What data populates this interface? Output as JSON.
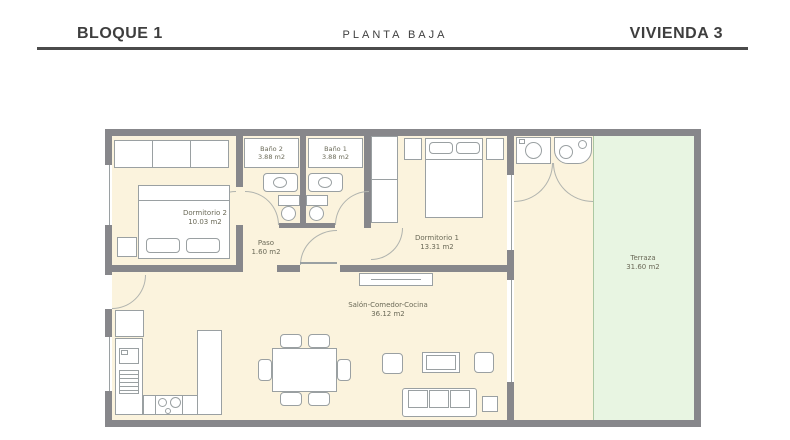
{
  "header": {
    "block_label": "BLOQUE 1",
    "plan_label": "PLANTA BAJA",
    "unit_label": "VIVIENDA 3"
  },
  "floorplan": {
    "rooms": {
      "dormitorio2": {
        "name": "Dormitorio 2",
        "area": "10.03 m2"
      },
      "bano2": {
        "name": "Baño 2",
        "area": "3.88 m2"
      },
      "bano1": {
        "name": "Baño 1",
        "area": "3.88 m2"
      },
      "paso": {
        "name": "Paso",
        "area": "1.60 m2"
      },
      "dormitorio1": {
        "name": "Dormitorio 1",
        "area": "13.31 m2"
      },
      "salon": {
        "name": "Salón-Comedor-Cocina",
        "area": "36.12 m2"
      },
      "terraza": {
        "name": "Terraza",
        "area": "31.60 m2"
      }
    },
    "colors": {
      "wall": "#87878b",
      "floor": "#fbf3dd",
      "terrace": "#e8f5e2",
      "furniture_line": "#9aa0a2",
      "label_text": "#6b6a58",
      "header_text": "#3e3e3e",
      "header_rule": "#4b4b4b"
    }
  }
}
